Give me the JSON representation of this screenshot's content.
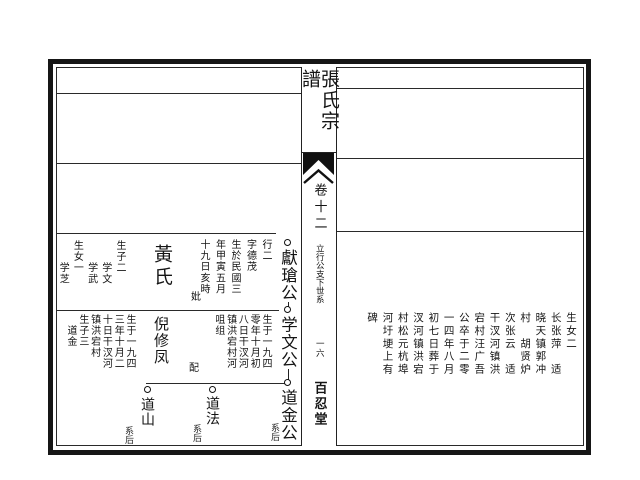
{
  "spine": {
    "title": "張氏宗譜",
    "volume": "卷十二",
    "section": "立行公支下世系",
    "page_number": "一六",
    "hall": "百忍堂"
  },
  "tree": {
    "gen1": {
      "node": "獻瑲公",
      "notes": [
        "行二",
        "字德茂",
        "生於民國三",
        "年甲寅五月",
        "十九日亥時"
      ],
      "spouse_prefix": "妣",
      "spouse": "黃氏",
      "children": [
        "生子二",
        "　　学文",
        "　　学武",
        "生女一",
        "　　学芝"
      ]
    },
    "gen2": {
      "node": "学文公",
      "notes": [
        "生于一九四",
        "零年十月初",
        "八日干汊河",
        "镇洪宕村河",
        "咀组"
      ],
      "spouse_prefix": "配",
      "spouse": "倪修凤",
      "spouse_notes": [
        "生于一九四",
        "三年十月二",
        "十日干汊河",
        "镇洪宕村",
        "生子三",
        "　道金"
      ]
    },
    "gen3": {
      "son1": "道金公",
      "son1_tag": "系后",
      "son2": "道法",
      "son2_tag": "系后",
      "son3": "道山",
      "son3_tag": "系后"
    }
  },
  "right_page": {
    "columns": [
      "生女二",
      "长张萍　适",
      "晓天镇郭冲",
      "村　胡贤炉",
      "次张云　适",
      "干汊河镇洪",
      "宕村汪广吾",
      "公卒于二零",
      "一四年八月",
      "初七日葬于",
      "汊河镇洪宕",
      "村松元杭埠",
      "河圩埂上有",
      "碑"
    ]
  }
}
